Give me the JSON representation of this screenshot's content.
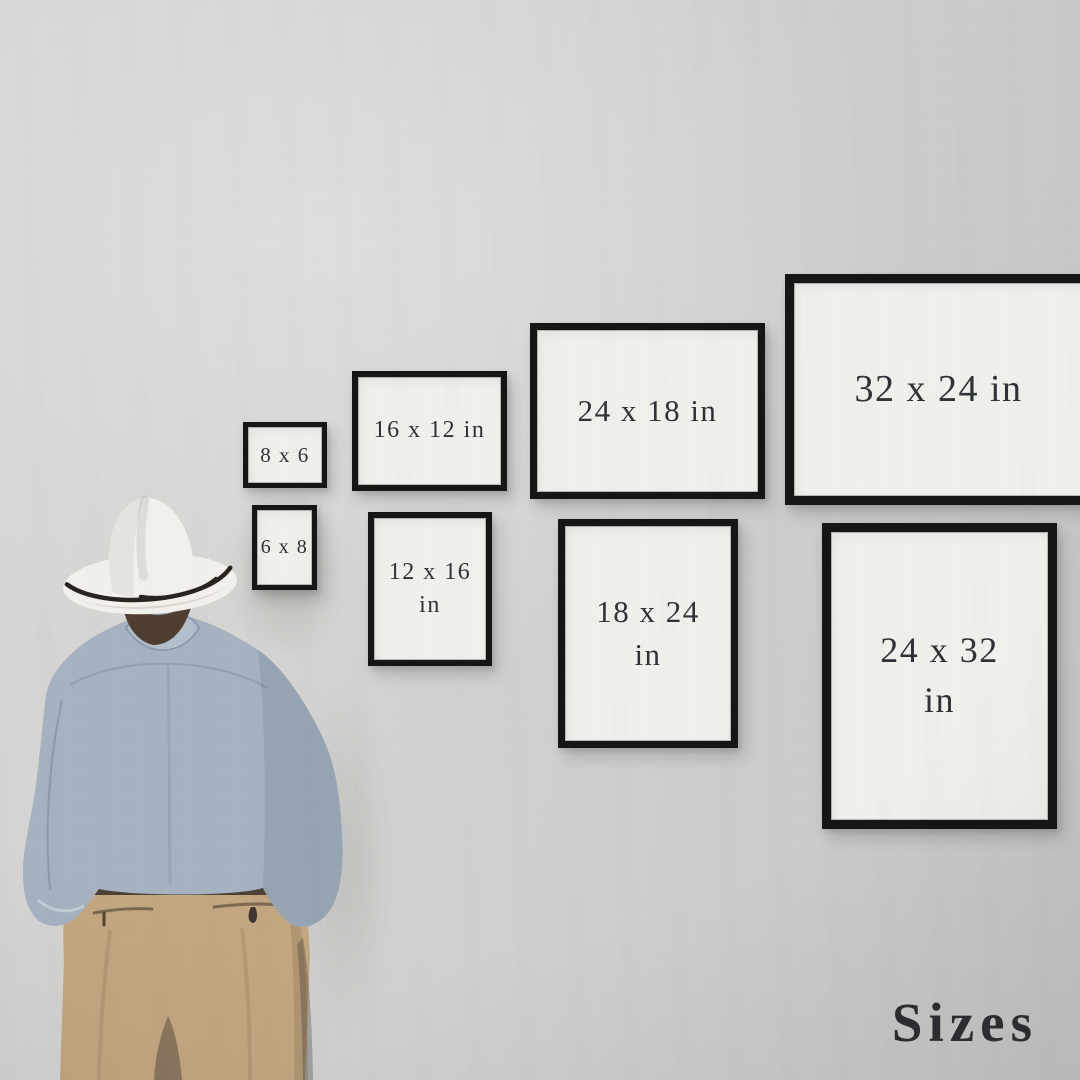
{
  "watermark": {
    "text": "Sizes"
  },
  "frames": [
    {
      "id": "8x6",
      "orientation": "landscape",
      "row": "top",
      "label": "8 x 6"
    },
    {
      "id": "16x12",
      "orientation": "landscape",
      "row": "top",
      "label": "16 x 12 in"
    },
    {
      "id": "24x18",
      "orientation": "landscape",
      "row": "top",
      "label": "24 x 18 in"
    },
    {
      "id": "32x24",
      "orientation": "landscape",
      "row": "top",
      "label": "32 x 24 in"
    },
    {
      "id": "6x8",
      "orientation": "portrait",
      "row": "bottom",
      "label": "6 x 8"
    },
    {
      "id": "12x16",
      "orientation": "portrait",
      "row": "bottom",
      "label": "12 x 16",
      "label_line2": "in"
    },
    {
      "id": "18x24",
      "orientation": "portrait",
      "row": "bottom",
      "label": "18 x 24",
      "label_line2": "in"
    },
    {
      "id": "24x32",
      "orientation": "portrait",
      "row": "bottom",
      "label": "24 x 32",
      "label_line2": "in"
    }
  ],
  "palette": {
    "wall": "#d7d7d5",
    "frame_border": "#161616",
    "frame_mat": "#f0f1ed",
    "label_text": "#2f3236",
    "watermark_text": "#2b2e32",
    "shirt": "#a7b3c1",
    "pants": "#c4a781",
    "belt": "#41362e",
    "hat": "#f3f1eb",
    "hat_band": "#2a241f",
    "hair": "#4f3f33"
  }
}
